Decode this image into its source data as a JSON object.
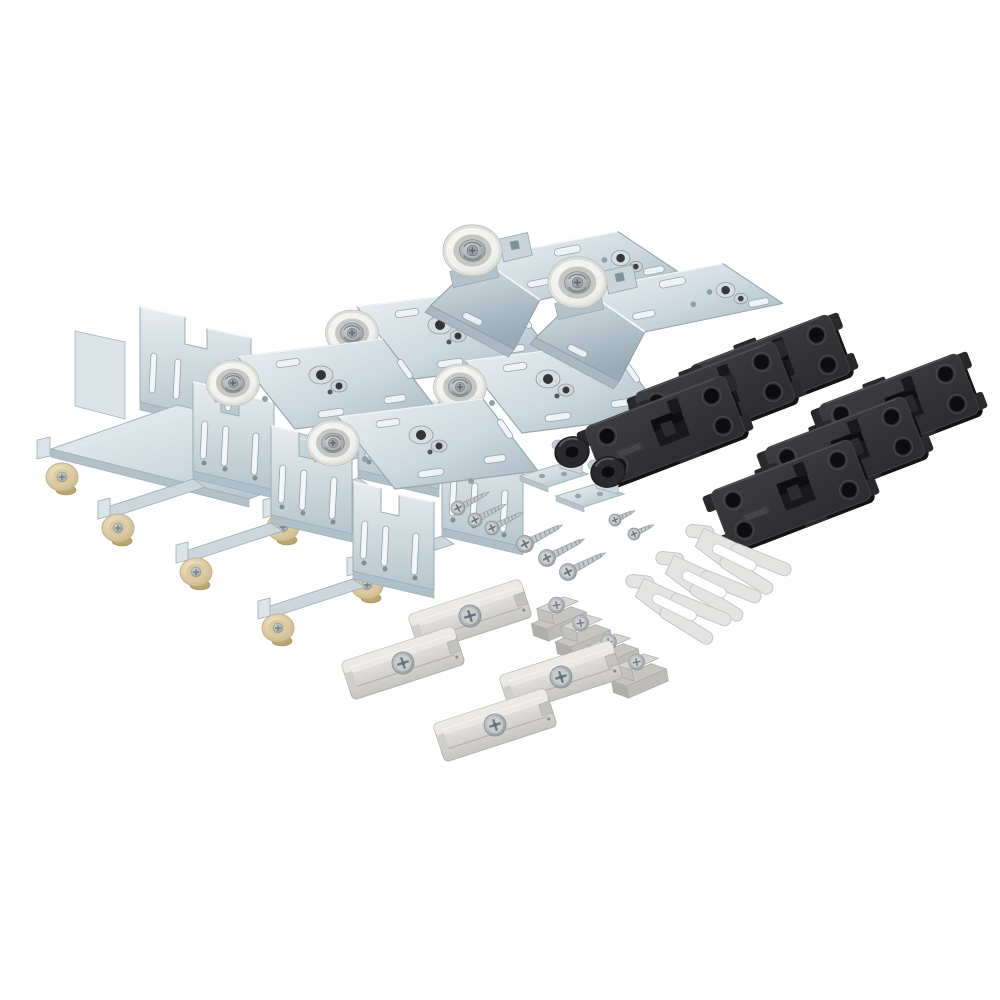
{
  "image": {
    "description": "Product photo: sliding-door hardware fitting kit laid out diagonally on a white background — zinc-plated top roller carriers, roller mounting plates, bottom guide brackets with cream nylon rollers, black plastic cover plates, grey plastic guide clips, translucent spacer forks, rubber door stops and assorted screws.",
    "background": "#ffffff"
  },
  "palette": {
    "background": "#ffffff",
    "zinc_light": "#ebf1f4",
    "zinc_mid": "#ccd9df",
    "zinc_dark": "#a6b7c0",
    "zinc_edge": "#97a8b1",
    "roller_white": "#efefed",
    "roller_hub": "#c6c6c2",
    "metal": "#b6bcbf",
    "metal_dark": "#6e7477",
    "cream": "#ead9b1",
    "cream_dark": "#c9b283",
    "black_plastic": "#2e2e31",
    "black_plastic_deep": "#131315",
    "gray_plastic": "#d8d7d3",
    "gray_plastic_shade": "#b4b3af",
    "light_plastic": "#e4e4e2",
    "rubber_black": "#2a2a2c",
    "brass": "#b9a66f"
  },
  "parts": [
    {
      "id": "bottom-guide-channel-bracket",
      "label": "Bottom guide channel bracket with nylon roller",
      "count": 1,
      "symbol": "sym-channel",
      "instances": [
        {
          "x": 37,
          "y": 301
        }
      ]
    },
    {
      "id": "bottom-guide-bracket",
      "label": "Bottom guide bracket with cream nylon roller",
      "count": 5,
      "symbol": "sym-bottom-bracket",
      "instances": [
        {
          "x": 263,
          "y": 369
        },
        {
          "x": 347,
          "y": 427
        },
        {
          "x": 98,
          "y": 370
        },
        {
          "x": 176,
          "y": 414
        },
        {
          "x": 258,
          "y": 470
        }
      ]
    },
    {
      "id": "roller-mounting-plate",
      "label": "Roller mounting plate with white wheel and adjusting bolts",
      "count": 4,
      "symbol": "sym-flat-plate",
      "instances": [
        {
          "x": 352,
          "y": 333
        },
        {
          "x": 460,
          "y": 387
        },
        {
          "x": 233,
          "y": 383
        },
        {
          "x": 333,
          "y": 443
        }
      ]
    },
    {
      "id": "top-roller-carrier",
      "label": "Top roller carrier bracket with large running wheel",
      "count": 2,
      "symbol": "sym-carrier",
      "instances": [
        {
          "x": 423,
          "y": 222,
          "s": 0.95
        },
        {
          "x": 528,
          "y": 254,
          "s": 0.95
        }
      ]
    },
    {
      "id": "cover-plate-black",
      "label": "Black plastic cover / soft-stop plate",
      "count": 6,
      "symbol": "sym-black-plate",
      "instances": [
        {
          "x": 770,
          "y": 370,
          "r": -21
        },
        {
          "x": 715,
          "y": 397,
          "r": -21
        },
        {
          "x": 665,
          "y": 431,
          "r": -21
        },
        {
          "x": 899,
          "y": 409,
          "r": -21
        },
        {
          "x": 845,
          "y": 452,
          "r": -21
        },
        {
          "x": 791,
          "y": 495,
          "r": -21
        }
      ]
    },
    {
      "id": "door-stop-bracket",
      "label": "Angle bracket with black rubber stop buffer",
      "count": 2,
      "symbol": "sym-door-stop",
      "instances": [
        {
          "x": 520,
          "y": 430
        },
        {
          "x": 556,
          "y": 450
        }
      ]
    },
    {
      "id": "flat-head-screw",
      "label": "Countersunk flat-head screw",
      "count": 3,
      "symbol": "sym-screw-flat",
      "instances": [
        {
          "x": 458,
          "y": 508,
          "r": -27
        },
        {
          "x": 475,
          "y": 520,
          "r": -27
        },
        {
          "x": 492,
          "y": 528,
          "r": -27
        }
      ]
    },
    {
      "id": "pan-head-screw",
      "label": "Large pan-head wood screw",
      "count": 3,
      "symbol": "sym-screw-pan",
      "instances": [
        {
          "x": 525,
          "y": 544,
          "r": -27
        },
        {
          "x": 547,
          "y": 558,
          "r": -27
        },
        {
          "x": 568,
          "y": 572,
          "r": -27
        }
      ]
    },
    {
      "id": "machine-screw-small",
      "label": "Small pan-head machine screw",
      "count": 2,
      "symbol": "sym-screw-small",
      "instances": [
        {
          "x": 615,
          "y": 520,
          "r": -25
        },
        {
          "x": 634,
          "y": 534,
          "r": -25
        }
      ]
    },
    {
      "id": "spacer-fork",
      "label": "Light grey forked spacer clip",
      "count": 3,
      "symbol": "sym-fork",
      "instances": [
        {
          "x": 688,
          "y": 518,
          "r": 14
        },
        {
          "x": 658,
          "y": 545,
          "r": 14
        },
        {
          "x": 628,
          "y": 568,
          "r": 14
        }
      ]
    },
    {
      "id": "adjustment-block",
      "label": "Grey stepped adjustment block with screw",
      "count": 4,
      "symbol": "sym-angle-block",
      "instances": [
        {
          "x": 558,
          "y": 613,
          "r": -10
        },
        {
          "x": 582,
          "y": 631,
          "r": -10
        },
        {
          "x": 610,
          "y": 650,
          "r": -10
        },
        {
          "x": 638,
          "y": 670,
          "r": -10
        }
      ]
    },
    {
      "id": "guide-clip",
      "label": "Grey plastic guide clip with centre screw",
      "count": 4,
      "symbol": "sym-gray-clip",
      "instances": [
        {
          "x": 470,
          "y": 616,
          "r": -18
        },
        {
          "x": 403,
          "y": 663,
          "r": -18
        },
        {
          "x": 561,
          "y": 677,
          "r": -18
        },
        {
          "x": 495,
          "y": 725,
          "r": -18
        }
      ]
    }
  ]
}
